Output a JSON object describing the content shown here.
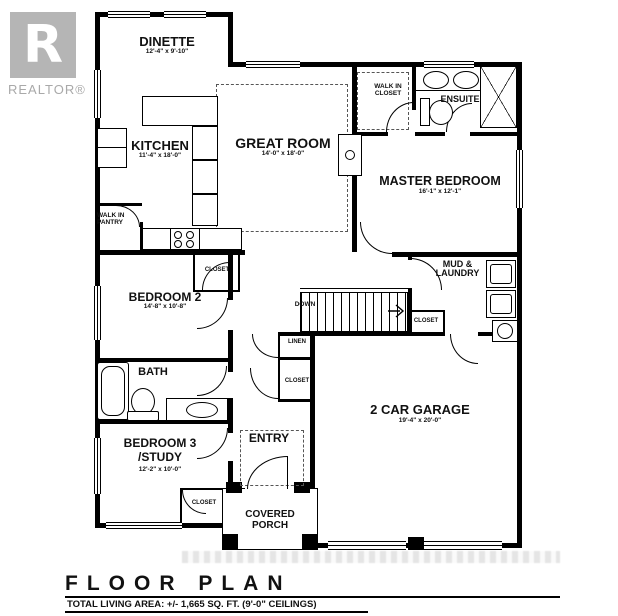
{
  "colors": {
    "line": "#000000",
    "logo_gray": "#b5b5b5",
    "watermark_gray": "#c9c9c9"
  },
  "branding": {
    "logo_letter": "R",
    "logo_wordmark": "REALTOR®"
  },
  "rooms": {
    "dinette": {
      "name": "DINETTE",
      "dims": "12'-4\" x 9'-10\""
    },
    "kitchen": {
      "name": "KITCHEN",
      "dims": "11'-4\" x 18'-0\""
    },
    "great_room": {
      "name": "GREAT ROOM",
      "dims": "14'-0\" x 18'-0\""
    },
    "master_bedroom": {
      "name": "MASTER BEDROOM",
      "dims": "16'-1\" x 12'-1\""
    },
    "walk_in_closet": {
      "line1": "WALK IN",
      "line2": "CLOSET"
    },
    "ensuite": {
      "name": "ENSUITE"
    },
    "mud_laundry": {
      "line1": "MUD &",
      "line2": "LAUNDRY"
    },
    "bedroom_2": {
      "name": "BEDROOM 2",
      "dims": "14'-8\" x 10'-8\""
    },
    "bath": {
      "name": "BATH"
    },
    "bedroom_3": {
      "line1": "BEDROOM 3",
      "line2": "/STUDY",
      "dims": "12'-2\" x 10'-0\""
    },
    "entry": {
      "name": "ENTRY"
    },
    "covered_porch": {
      "line1": "COVERED",
      "line2": "PORCH"
    },
    "garage": {
      "name": "2 CAR GARAGE",
      "dims": "19'-4\" x 20'-0\""
    },
    "walk_in_pantry": {
      "line1": "WALK IN",
      "line2": "PANTRY"
    }
  },
  "annotations": {
    "down": "DOWN",
    "linen": "LINEN",
    "closet_bedroom_2": "CLOSET",
    "closet_hall": "CLOSET",
    "closet_mud_laundry": "CLOSET",
    "closet_bedroom_3": "CLOSET"
  },
  "title_block": {
    "title": "FLOOR PLAN",
    "area_note": "TOTAL LIVING AREA:  +/- 1,665 SQ. FT.  (9'-0\" CEILINGS)"
  }
}
